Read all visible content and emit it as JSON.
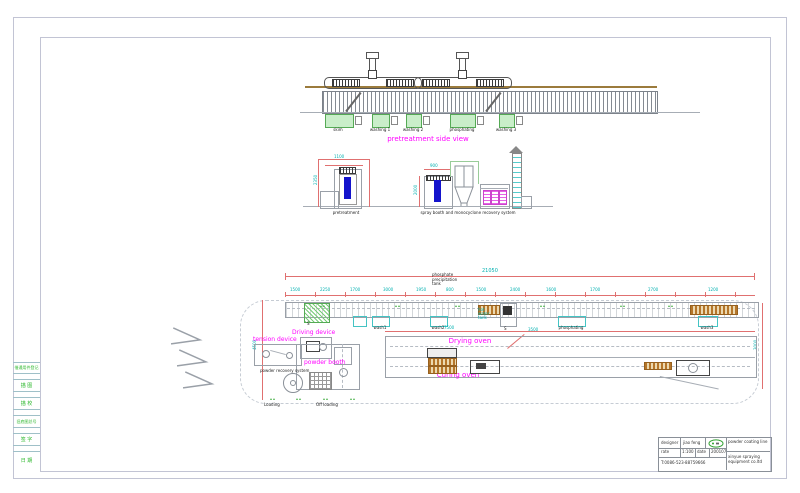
{
  "side_view": {
    "title": "pretreatment side view",
    "tank_labels": [
      "skim",
      "washing 1",
      "washing 2",
      "phosphating",
      "washing 3"
    ]
  },
  "elevation": {
    "pretreatment_label": "pretreatment",
    "spray_system_label": "spray booth and monocyclone recovery system",
    "dims": [
      "2350",
      "1100",
      "2000",
      "900"
    ]
  },
  "plan": {
    "phosphate_note_lines": [
      "phosphate",
      "precipitation",
      "tank"
    ],
    "driving_device": "Driving device",
    "tension_device": "tension device",
    "powder_booth": "powder booth",
    "drying_oven": "Drying oven",
    "curing_oven": "Curing oven",
    "loading": "Loading",
    "off_loading": "Off loading",
    "powder_recovery": "powder recovery system",
    "station_labels": [
      "wash1",
      "wash2",
      "phosphating",
      "wash3"
    ],
    "hot_tank_lines": [
      "hot",
      "water",
      "tank"
    ],
    "station_mark": "S",
    "dims": {
      "overall": "21050",
      "oven": "7500",
      "left": "4500",
      "right": "3000",
      "diag": "3500",
      "ticks": [
        "1500",
        "2250",
        "1700",
        "3000",
        "1950",
        "800",
        "1500",
        "2400",
        "1600",
        "1700",
        "2700",
        "1200"
      ]
    }
  },
  "title_block": {
    "designer_label": "designer",
    "designer_name": "jiao feng",
    "scale_label": "rate",
    "scale_value": "1:100",
    "date_label": "date",
    "date_value": "200107",
    "phone": "T:0086-523-88759666",
    "product": "powder coating line",
    "company": "xinyue spraying equipment co.ltd"
  },
  "left_strip": {
    "cells": [
      "借通用件登记",
      "描 图",
      "描 校",
      "旧底图总号",
      "签 字",
      "日 期"
    ]
  },
  "colors": {
    "label_magenta": "#ff00ff",
    "dim_red": "#e07070",
    "dim_cyan": "#00b0b0",
    "tank_green": "#c9eec9",
    "line_gray": "#9aa0a8",
    "rail_brown": "#9b7b3c",
    "door_blue": "#1414cc",
    "filter_magenta": "#e565e5",
    "strip_text_green": "#2db82d"
  }
}
